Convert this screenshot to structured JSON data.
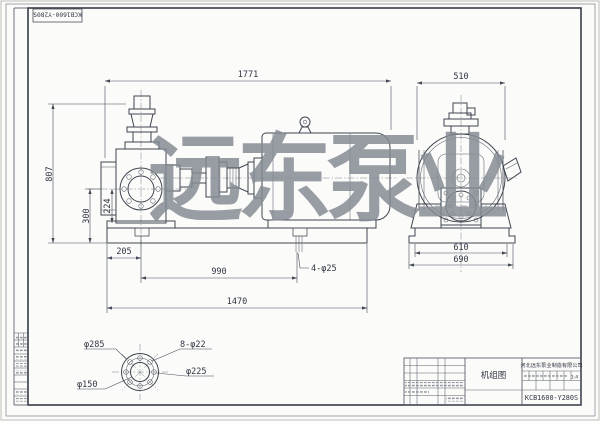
{
  "sheet": {
    "watermark": "远东泵业",
    "corner_label": "KCB1600-Y280S"
  },
  "title_block": {
    "drawing_title": "机组图",
    "company": "河北远东泵业制造有限公司",
    "drawing_number": "KCB1600-Y280S",
    "scale": "1:4"
  },
  "front_view": {
    "overall_length": "1771",
    "overall_height": "807",
    "inlet_center_height": "300",
    "port_center_height": "224",
    "anchor_offset": "205",
    "anchor_spacing": "990",
    "anchor_holes": "4-φ25",
    "base_length": "1470"
  },
  "end_view": {
    "overall_width": "510",
    "base_top_width": "610",
    "base_bottom_width": "690"
  },
  "flange_detail": {
    "outer_diameter": "φ285",
    "bolt_holes": "8-φ22",
    "bolt_circle_diameter": "φ225",
    "bore_diameter": "φ150"
  }
}
